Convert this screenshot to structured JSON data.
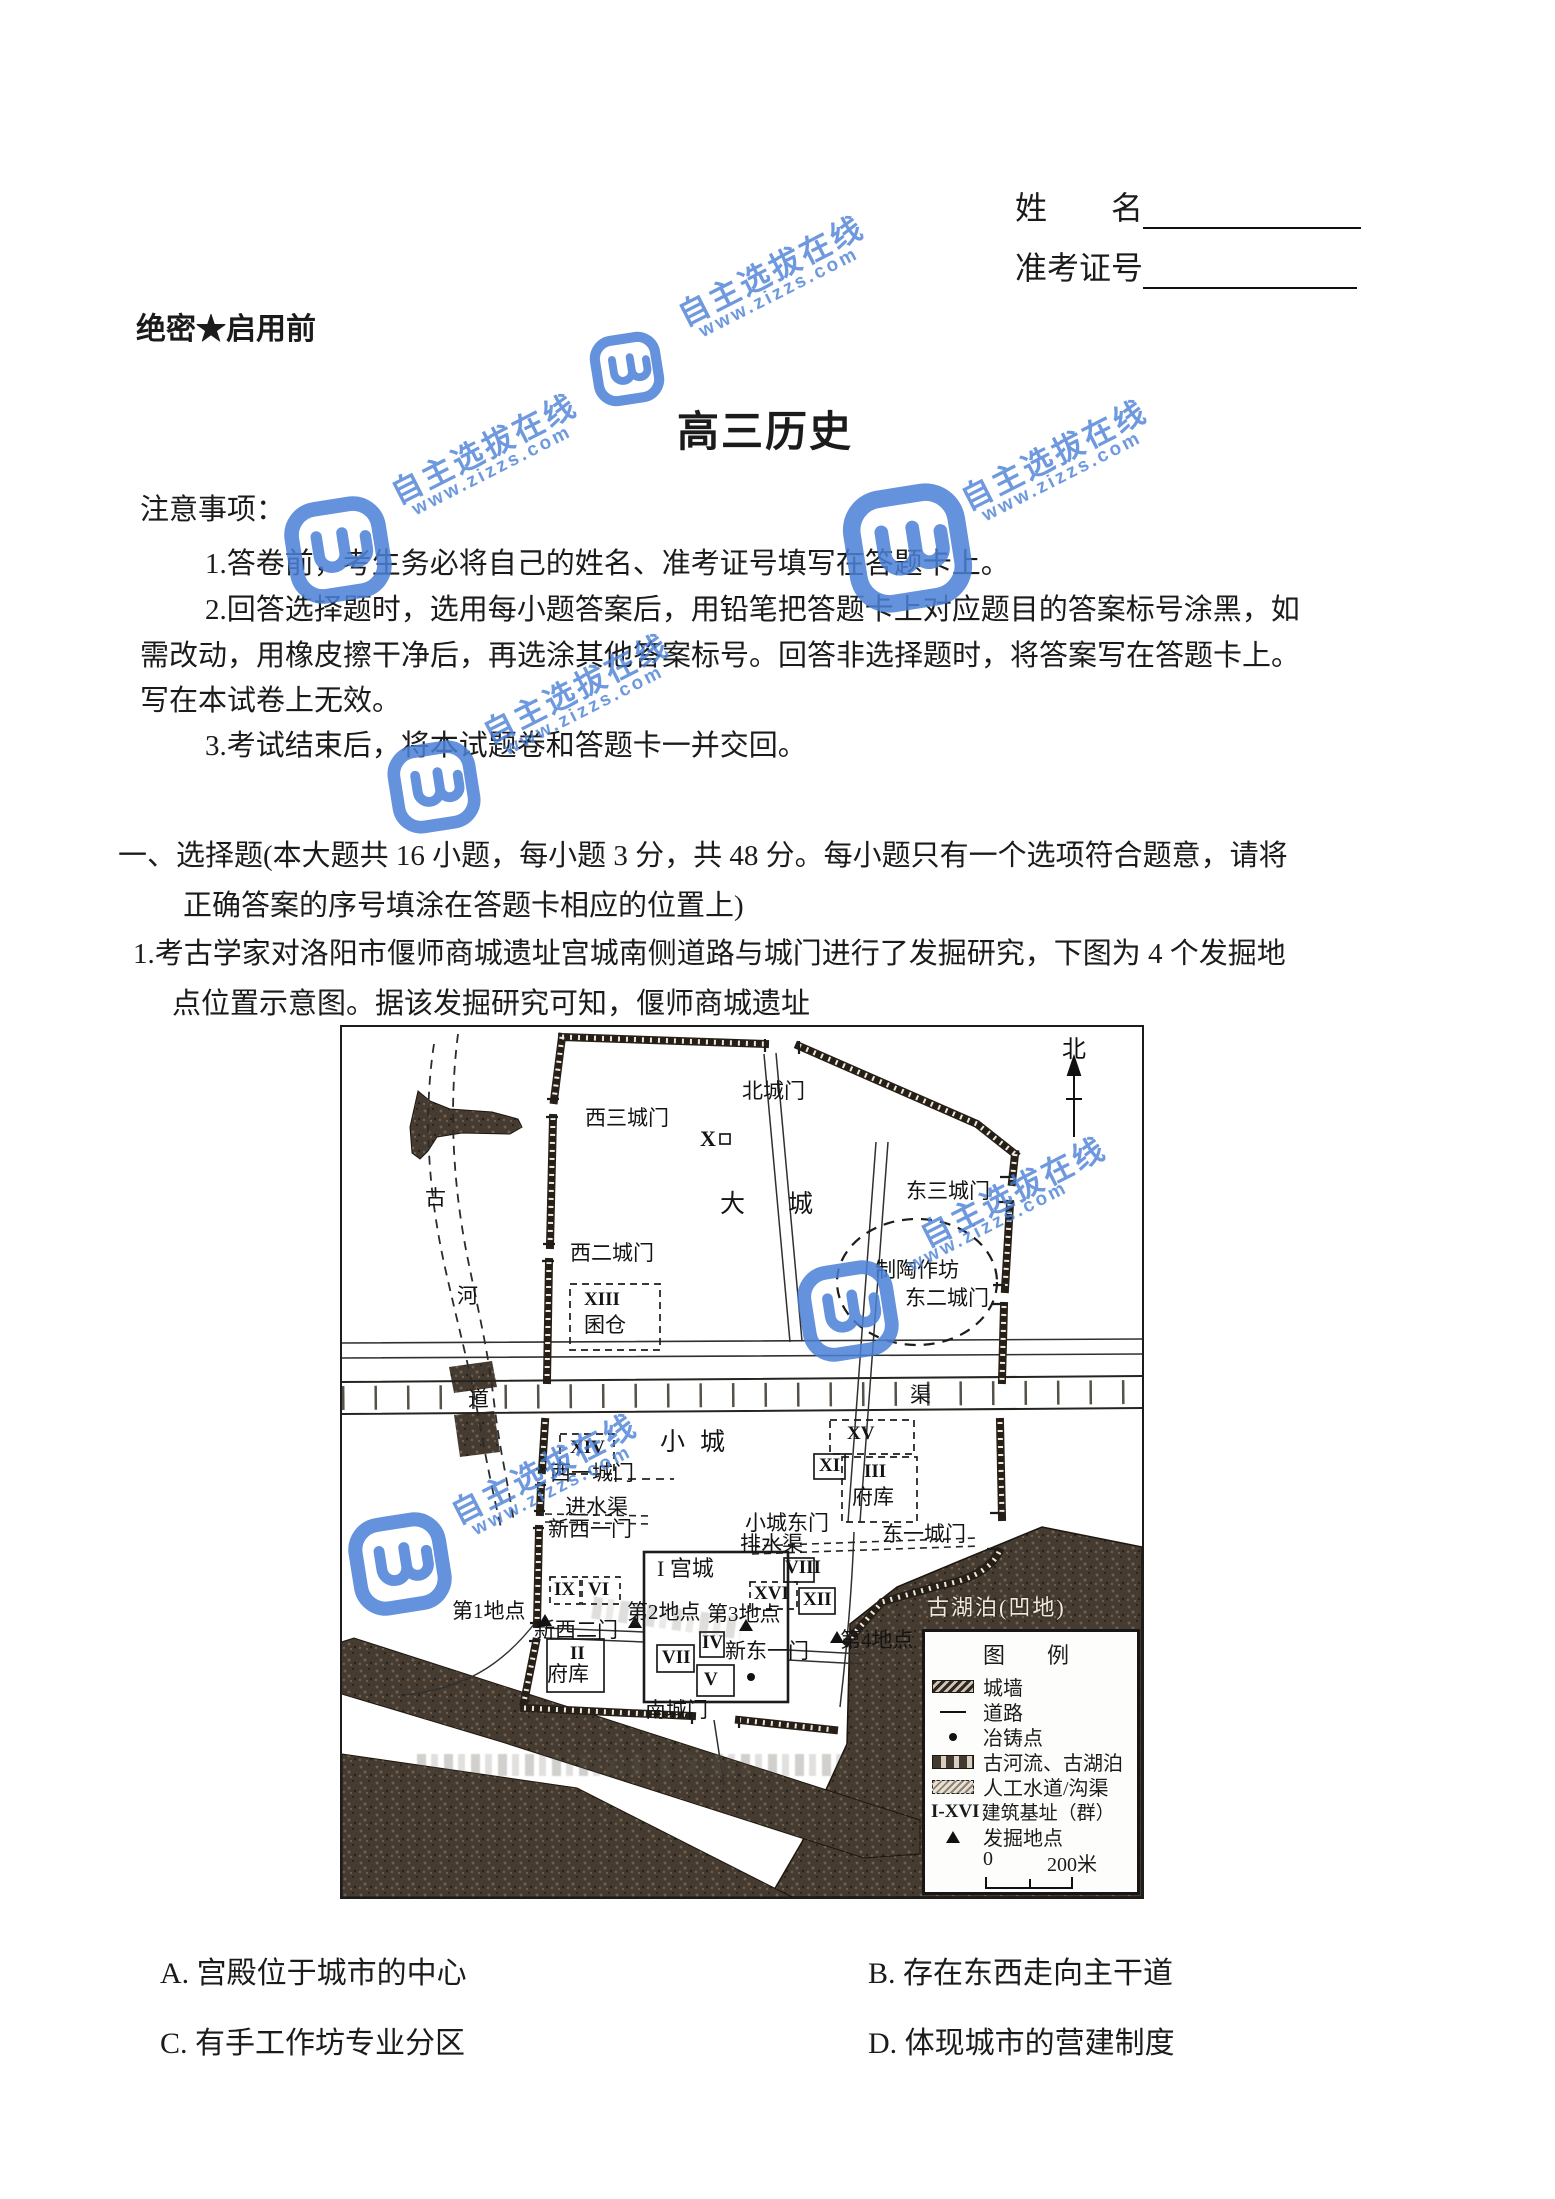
{
  "header": {
    "name_label": "姓　　名",
    "exam_id_label": "准考证号",
    "secrecy_label": "绝密★启用前",
    "title": "高三历史"
  },
  "notes": {
    "heading": "注意事项：",
    "item1": "1.答卷前，考生务必将自己的姓名、准考证号填写在答题卡上。",
    "item2_line1": "2.回答选择题时，选用每小题答案后，用铅笔把答题卡上对应题目的答案标号涂黑，如",
    "item2_line2": "需改动，用橡皮擦干净后，再选涂其他答案标号。回答非选择题时，将答案写在答题卡上。",
    "item2_line3": "写在本试卷上无效。",
    "item3": "3.考试结束后，将本试题卷和答题卡一并交回。"
  },
  "section": {
    "line1": "一、选择题(本大题共 16 小题，每小题 3 分，共 48 分。每小题只有一个选项符合题意，请将",
    "line2": "正确答案的序号填涂在答题卡相应的位置上)"
  },
  "question1": {
    "line1": "1.考古学家对洛阳市偃师商城遗址宫城南侧道路与城门进行了发掘研究，下图为 4 个发掘地",
    "line2": "点位置示意图。据该发掘研究可知，偃师商城遗址",
    "option_a": "A. 宫殿位于城市的中心",
    "option_b": "B. 存在东西走向主干道",
    "option_c": "C. 有手工作坊专业分区",
    "option_d": "D. 体现城市的营建制度"
  },
  "map": {
    "compass": "北",
    "labels": {
      "beichengmen": "北城门",
      "xisanchengmen": "西三城门",
      "x": "X",
      "dacheng_a": "大",
      "dacheng_b": "城",
      "dongsanchengmen": "东三城门",
      "zhitaozuofang": "制陶作坊",
      "dongerchengmen": "东二城门",
      "xierchengmen": "西二城门",
      "xiii": "XIII",
      "quncang": "囷仓",
      "gu": "古",
      "he": "河",
      "dao": "道",
      "qu": "渠",
      "xiv": "XIV",
      "xiaocheng_a": "小",
      "xiaocheng_b": "城",
      "xv": "XV",
      "xiyichengmen": "西一城门",
      "xi": "XI",
      "iii": "III",
      "jinshuiqu": "进水渠",
      "fuku_e": "府库",
      "xinxiyimen": "新西一门",
      "xiaochengdongmen": "小城东门",
      "paishuiqu": "排水渠",
      "dongyichengmen": "东一城门",
      "gongcheng": "I 宫城",
      "viii": "VIII",
      "ix": "IX",
      "vi": "VI",
      "xvi": "XVI",
      "xii": "XII",
      "d1": "第1地点",
      "d2": "第2地点",
      "d3": "第3地点",
      "d4": "第4地点",
      "xinxiermen": "新西二门",
      "ii": "II",
      "fuku_w": "府库",
      "vii": "VII",
      "iv": "IV",
      "xindongyimen": "新东一门",
      "v": "V",
      "nanchengmen": "南城门",
      "guhupo": "古湖泊(凹地)"
    },
    "legend": {
      "title": "图　例",
      "wall": "城墙",
      "road": "道路",
      "cast": "冶铸点",
      "river": "古河流、古湖泊",
      "canal": "人工水道/沟渠",
      "base_prefix": "I-XVI",
      "base": "建筑基址（群）",
      "dig": "发掘地点",
      "scale_zero": "0",
      "scale_end": "200米"
    }
  },
  "watermark": {
    "text": "自主选拔在线",
    "url": "www.zizzs.com",
    "color": "#4a80d6"
  }
}
